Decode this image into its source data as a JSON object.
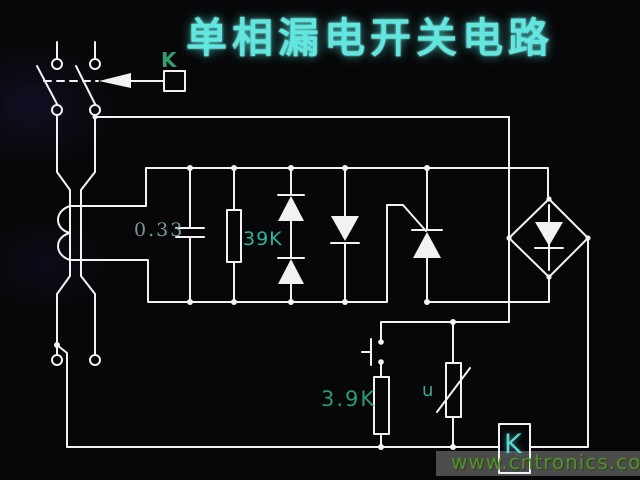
{
  "title": "单相漏电开关电路",
  "watermark": "www.cntronics.com",
  "colors": {
    "background": "#070709",
    "wire": "#f2f2f2",
    "title_text": "#63e6df",
    "relay_linkage_label": "#2fa06e",
    "capacitor_label": "#7a9894",
    "resistor_39k_label": "#2fb3a3",
    "resistor_39_label": "#2b9a72",
    "varistor_label": "#3da894",
    "relay_coil_label": "#5cd6d0",
    "watermark_text": "#4a9428",
    "watermark_band": "#575757"
  },
  "components": {
    "relay_linkage": {
      "label": "K"
    },
    "relay_coil": {
      "label": "K"
    },
    "capacitor": {
      "label": "0.33"
    },
    "resistor_divider": {
      "label": "39K"
    },
    "resistor_test": {
      "label": "3.9K"
    },
    "varistor": {
      "label": "u"
    }
  }
}
